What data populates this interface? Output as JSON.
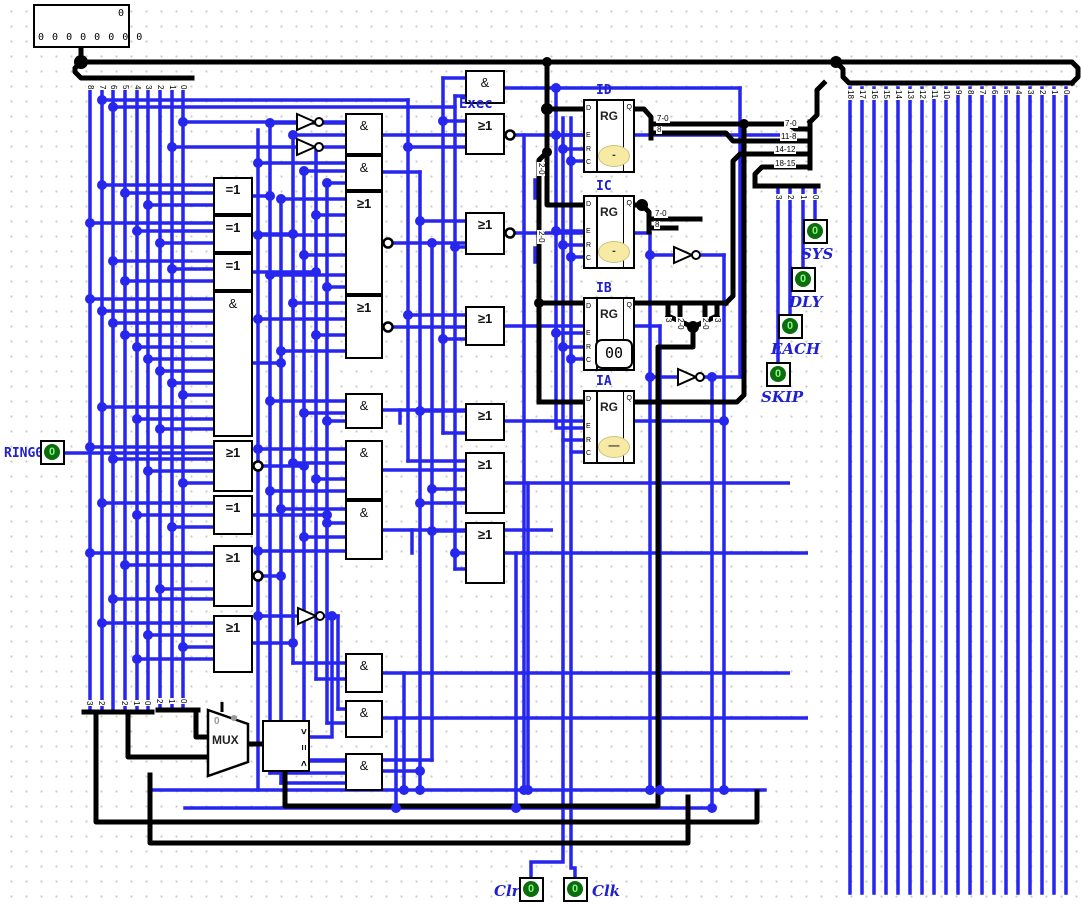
{
  "app": {
    "type": "logic-circuit-canvas"
  },
  "labels": {
    "and": "&",
    "or": "≥1",
    "xor": "=1",
    "mux": "MUX",
    "rg": "RG",
    "exec": "Exec",
    "cmp_gt": ">",
    "cmp_eq": "=",
    "cmp_lt": "<",
    "mux_sel": "0"
  },
  "display": {
    "value": "0",
    "bits": "0 0 0 0 0 0 0 0"
  },
  "registers": [
    {
      "name": "ID",
      "value": "-"
    },
    {
      "name": "IC",
      "value": "-"
    },
    {
      "name": "IB",
      "value": "00"
    },
    {
      "name": "IA",
      "value": "—"
    }
  ],
  "register_pins": {
    "d": "D",
    "e": "E",
    "r": "R",
    "c": "C",
    "q": "Q"
  },
  "inputs": {
    "ring0": {
      "label": "RING0",
      "value": "0"
    },
    "clr": {
      "label": "Clr",
      "value": "0"
    },
    "clk": {
      "label": "Clk",
      "value": "0"
    }
  },
  "outputs": [
    {
      "label": "SYS",
      "value": "0"
    },
    {
      "label": "DLY",
      "value": "0"
    },
    {
      "label": "EACH",
      "value": "0"
    },
    {
      "label": "SKIP",
      "value": "0"
    }
  ],
  "bus_labels": {
    "left": [
      "8",
      "7",
      "6",
      "5",
      "4",
      "3",
      "2",
      "1",
      "0"
    ],
    "right": [
      "18",
      "17",
      "16",
      "15",
      "14",
      "13",
      "12",
      "11",
      "10",
      "9",
      "8",
      "7",
      "6",
      "5",
      "4",
      "3",
      "2",
      "1",
      "0"
    ],
    "merger": [
      "7-0",
      "11-8",
      "14-12",
      "18-15"
    ],
    "id_split": [
      "7-0",
      "8"
    ],
    "ic_split": [
      "7-0",
      "8"
    ],
    "ib_split": [
      "3",
      "2-0",
      "2-0",
      "3"
    ],
    "mid_split": [
      "2-0",
      "2-0"
    ],
    "flag_split": [
      "3",
      "2",
      "1",
      "0"
    ],
    "bottom_mergers": [
      [
        "3",
        "2"
      ],
      [
        "2",
        "1",
        "0"
      ],
      [
        "2",
        "1",
        "0"
      ]
    ]
  },
  "colors": {
    "wire": "#2626ee",
    "bus": "#000000",
    "label_blue": "#2020cc",
    "led_green": "#0a6e0a",
    "led_text": "#8ef08e",
    "value_fill": "#f7eaa4"
  }
}
